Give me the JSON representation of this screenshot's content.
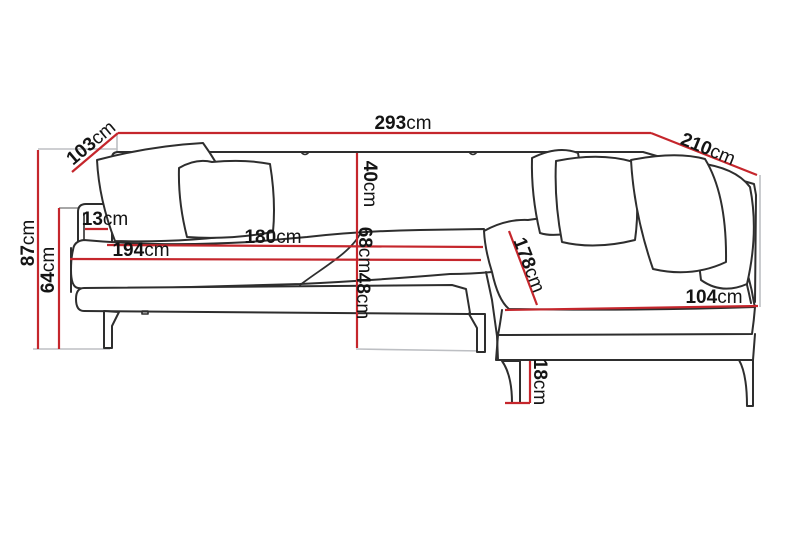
{
  "diagram": {
    "name": "corner-sofa-dimension-diagram",
    "unit": "cm",
    "colors": {
      "dimension_line": "#c5262c",
      "sofa_outline": "#2e2e2e",
      "extension_line": "#bdbfc3",
      "label_text": "#141414",
      "background": "#ffffff"
    },
    "dimensions": {
      "total_width": {
        "value": "293",
        "unit": "cm"
      },
      "left_depth": {
        "value": "103",
        "unit": "cm"
      },
      "right_side_length": {
        "value": "210",
        "unit": "cm"
      },
      "total_height": {
        "value": "87",
        "unit": "cm"
      },
      "armrest_height": {
        "value": "64",
        "unit": "cm"
      },
      "armrest_width": {
        "value": "13",
        "unit": "cm"
      },
      "seat_cushion_width": {
        "value": "180",
        "unit": "cm"
      },
      "interior_width": {
        "value": "194",
        "unit": "cm"
      },
      "backrest_height": {
        "value": "40",
        "unit": "cm"
      },
      "back_seat_height": {
        "value": "68",
        "unit": "cm"
      },
      "seat_height": {
        "value": "48",
        "unit": "cm"
      },
      "chaise_length": {
        "value": "178",
        "unit": "cm"
      },
      "chaise_width": {
        "value": "104",
        "unit": "cm"
      },
      "leg_height": {
        "value": "18",
        "unit": "cm"
      }
    }
  }
}
